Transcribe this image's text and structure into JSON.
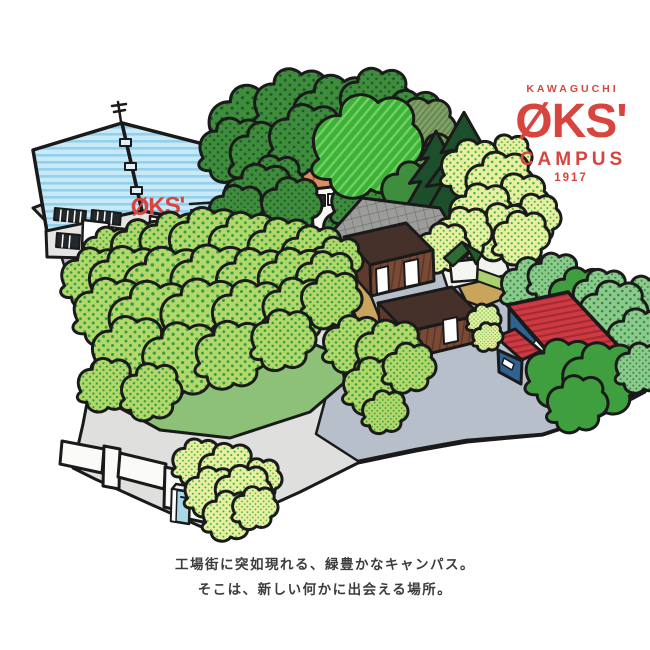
{
  "brand": {
    "location": "KAWAGUCHI",
    "name": "ØKS'",
    "sub": "CAMPUS",
    "year": "1917",
    "color": "#d7453e"
  },
  "illustration": {
    "factory_sign": "ØKS'"
  },
  "caption": {
    "line1": "工場街に突如現れる、緑豊かなキャンパス。",
    "line2": "そこは、新しい何かに出会える場所。"
  },
  "colors": {
    "logo_red": "#d7453e",
    "factory_roof_blue": "#c8e9f8",
    "warehouse_roof_red": "#ce3a42",
    "warehouse_wall_blue": "#2d6292",
    "barn_brown": "#7b4a36",
    "lawn_green": "#8cc177",
    "ground_gray": "#dfdfde",
    "ground_blue_gray": "#b6bfca",
    "tree_light_green": "#b3d76b",
    "tree_dark_green": "#3e8c3c",
    "tree_yellow_green": "#e9efa0",
    "path_tan": "#c9a45c"
  }
}
